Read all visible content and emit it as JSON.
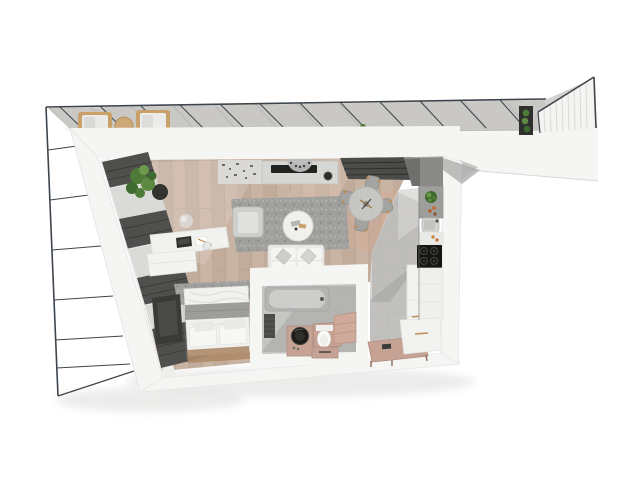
{
  "meta": {
    "type": "3d-floor-plan-render",
    "view": "top-down isometric render of a small studio apartment with a wrap-around balcony"
  },
  "palette": {
    "wall": "#f5f5f3",
    "wall_shade": "#aeaeac",
    "balcony_floor": "#c9c8c5",
    "balcony_floor_light": "#d2d1cd",
    "railing": "#3d454c",
    "wood_floor": "#c9b3a2",
    "wood_line": "#b19a89",
    "tile_floor": "#d7d6d3",
    "tile_line": "#c3c2bf",
    "bath_floor": "#c6c7c5",
    "shadow": "#8f8f8d",
    "rug": "#a0a09e",
    "cabinet_white": "#f2f2f0",
    "tan_cabinet": "#c6a294",
    "wood_furniture": "#c9a06a",
    "plant_green": "#4e7a38",
    "plant_dark": "#3d6a2e",
    "dark_panel": "#3a3a38",
    "cooktop_black": "#161614",
    "counter_gray": "#9e9e9c",
    "console_gray": "#d6d6d4",
    "tv_black": "#222220",
    "bed_white": "#f1f1ef",
    "blanket_gray": "#9d9d9b",
    "chair_gray": "#a3a3a1",
    "radiator_gray": "#4a4a48",
    "accent_yellow": "#d9b24a",
    "accent_orange": "#c96a2a"
  },
  "scene": {
    "balcony": {
      "items": [
        "railing",
        "lounge-chair-left",
        "lounge-chair-right",
        "round-side-table",
        "planter-box",
        "small-potted-plant"
      ]
    },
    "living_room": {
      "items": [
        "media-console",
        "tv",
        "speaker",
        "ceiling-lamp",
        "decor-shelf",
        "area-rug",
        "round-coffee-table",
        "armchair",
        "sofa",
        "throw-pillows",
        "window-blinds"
      ]
    },
    "dining_area": {
      "items": [
        "round-dining-table",
        "chair",
        "chair",
        "chair",
        "chair"
      ]
    },
    "work_area": {
      "items": [
        "desk",
        "laptop",
        "desk-lamp",
        "drawer-unit",
        "round-vase",
        "large-potted-plant"
      ]
    },
    "bedroom": {
      "items": [
        "double-bed",
        "pillows",
        "gray-blanket",
        "bedside-rug",
        "tv-panel",
        "foot-bench"
      ]
    },
    "bathroom": {
      "items": [
        "bathtub",
        "radiator",
        "washing-machine",
        "toilet",
        "tiled-steps",
        "tan-drawer"
      ]
    },
    "kitchen": {
      "items": [
        "tall-cabinets",
        "gray-countertop",
        "herb-plant",
        "spice-jars",
        "sink",
        "cooktop",
        "lower-counter",
        "base-cabinet"
      ]
    },
    "hallway": {
      "items": [
        "wardrobe",
        "entry-bench"
      ]
    }
  }
}
